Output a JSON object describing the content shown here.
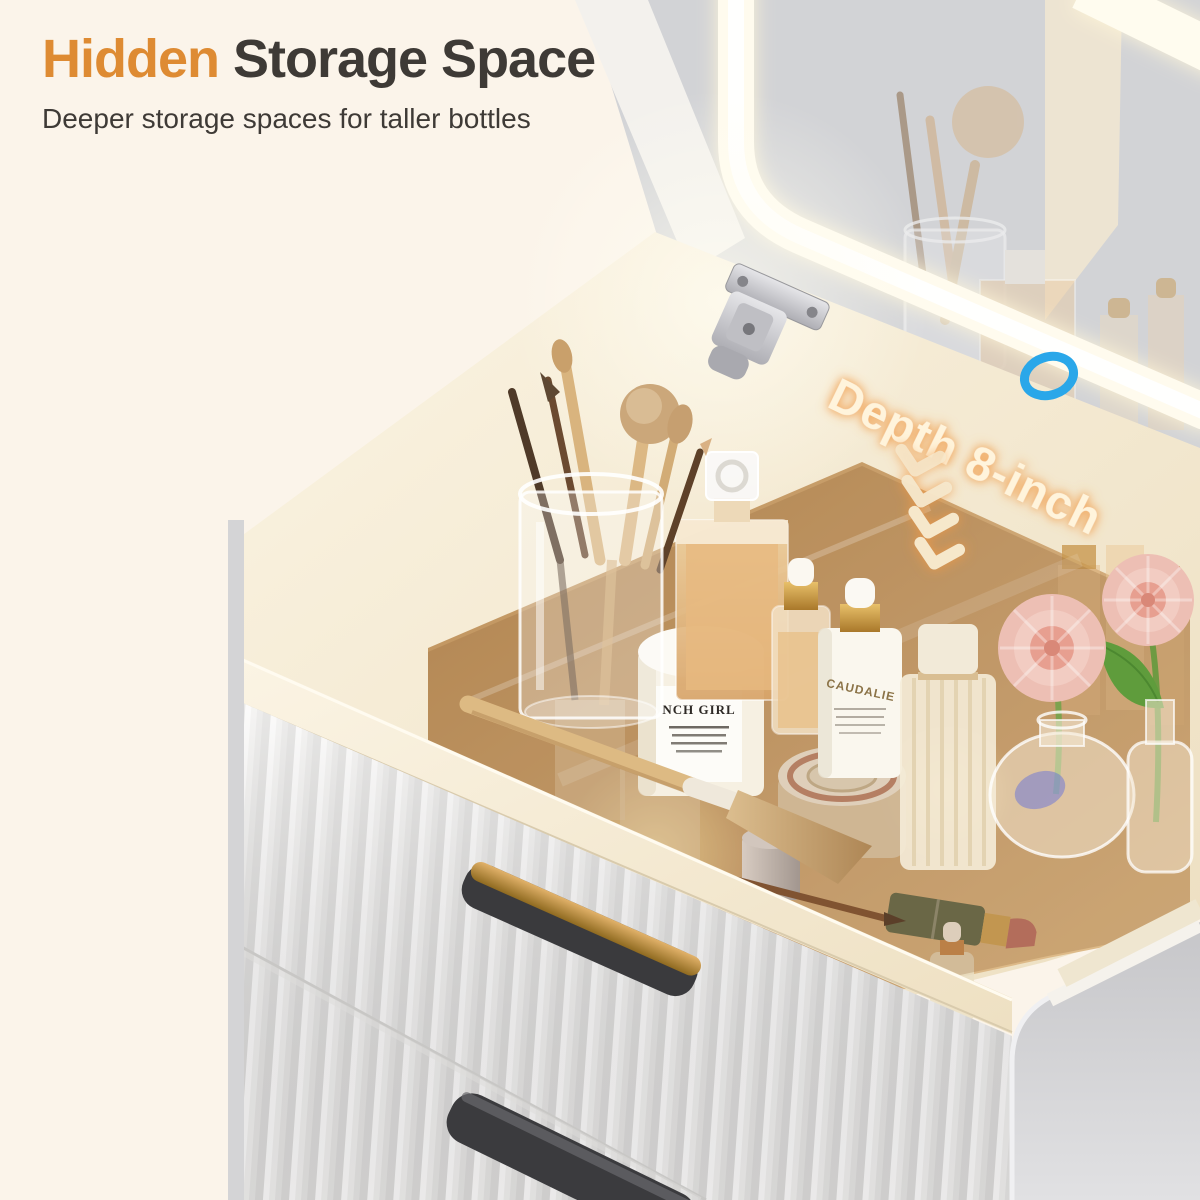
{
  "header": {
    "title_highlight": "Hidden",
    "title_rest": " Storage Space",
    "subtitle": "Deeper storage spaces for taller bottles"
  },
  "callout": {
    "depth_label": "Depth 8-inch"
  },
  "products": {
    "dropper_bottle_label": "CAUDALIE",
    "jar_label": "NCH GIRL"
  },
  "icons": {
    "chevron_down_count": 4,
    "highlight_ring": "blue-ellipse-outline"
  },
  "colors": {
    "background": "#FBF4EA",
    "title_highlight": "#DE8B33",
    "title_text": "#3E3A36",
    "callout_text": "#FFF4DC",
    "callout_glow": "#F09A44",
    "ring_blue": "#2AA7E9",
    "mirror_gray": "#D2D3D6",
    "cabinet_cream": "#F3E9D6",
    "drawer_white": "#EFEEEC",
    "handle_black": "#3A3A3D",
    "handle_gold": "#C99850",
    "flower_pink": "#EDBFB4",
    "leaf_green": "#5F9C3C"
  }
}
